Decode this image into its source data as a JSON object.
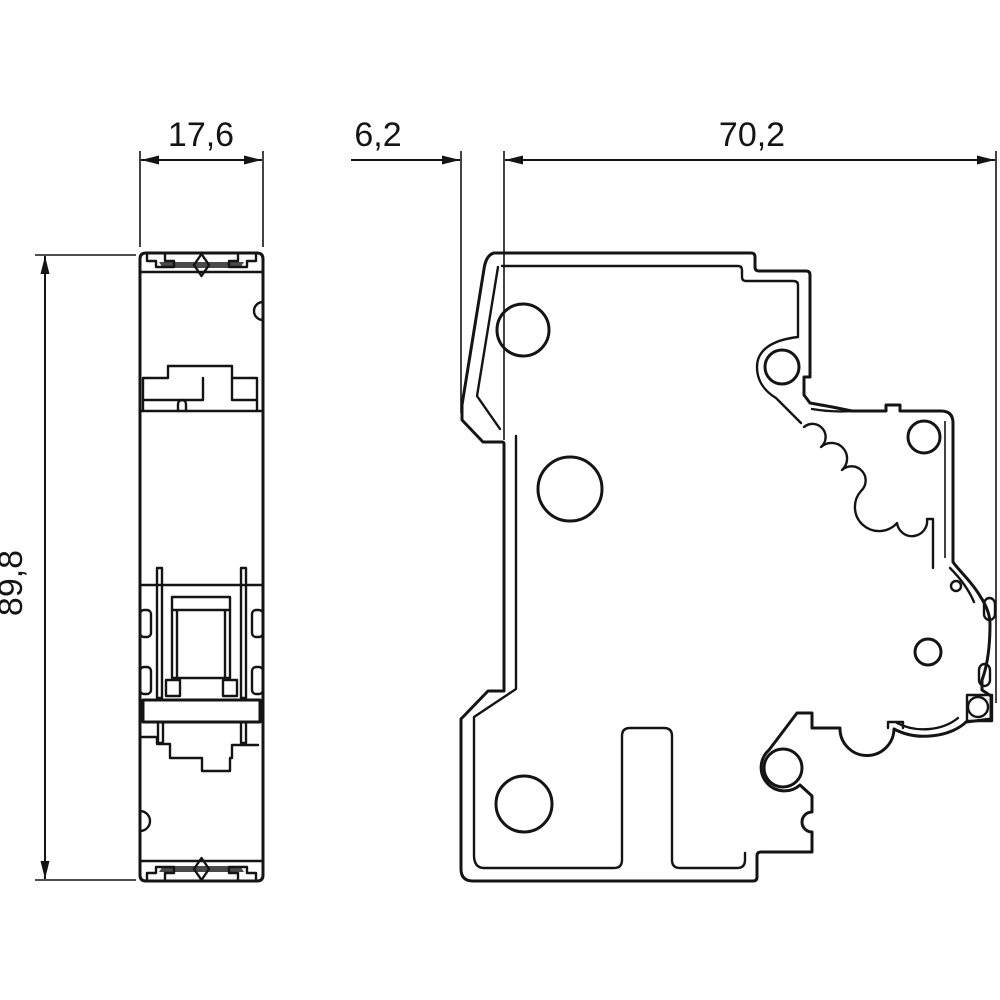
{
  "drawing": {
    "background": "#ffffff",
    "ink_color": "#141414",
    "clip_bar_fill": "#4a4a4a",
    "type": "technical-dimension-drawing",
    "views": [
      "front-view",
      "side-view"
    ]
  },
  "dimensions": {
    "front_width": "17,6",
    "toggle_projection": "6,2",
    "body_depth": "70,2",
    "height": "89,8"
  }
}
